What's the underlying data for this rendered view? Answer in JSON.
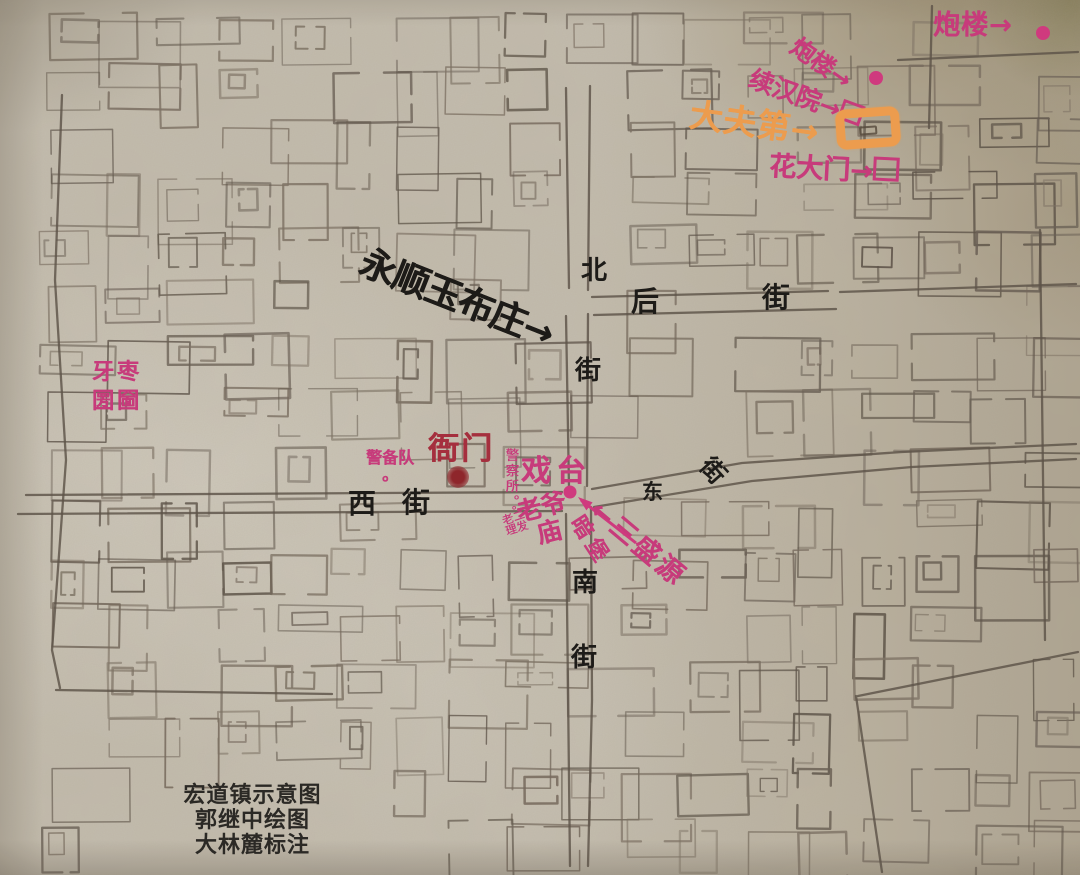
{
  "map": {
    "caption": {
      "line1": "宏道镇示意图",
      "line2": "郭继中绘图",
      "line3": "大林麓标注"
    },
    "streets": {
      "north": {
        "name": "北街",
        "c1": "北",
        "c2": "街"
      },
      "back": {
        "name": "后街",
        "c1": "后",
        "c2": "街"
      },
      "west": {
        "name": "西街",
        "c1": "西",
        "c2": "街"
      },
      "east": {
        "name": "东街",
        "c1": "东",
        "c2": "街"
      },
      "south": {
        "name": "南街",
        "c1": "南",
        "c2": "街"
      }
    },
    "landmarks": {
      "paolou_far": {
        "label": "炮楼→",
        "marker": "dot"
      },
      "paolou_near": {
        "label": "炮楼→",
        "marker": "dot"
      },
      "xuhanyuan": {
        "label": "续汉院→",
        "marker": "gate-box"
      },
      "dafudi": {
        "label": "大夫第→",
        "marker": "orange-highlight-box"
      },
      "huadamen": {
        "label": "花大门→",
        "marker": "gate-box"
      },
      "yongshunyu": {
        "label": "永顺玉布庄→"
      },
      "yazao_kulue": {
        "line1": "牙枣",
        "line2": "圐圙"
      },
      "jingbeidui": {
        "label": "警备队",
        "dot": "。"
      },
      "yamen": {
        "label": "衙门",
        "marker": "dot"
      },
      "jingchasuo": {
        "label": "警察所。"
      },
      "xitai": {
        "label": "戏台"
      },
      "laoyemiao": {
        "line1": "老爷",
        "line2": "庙",
        "marker": "dot"
      },
      "laoer_lifa": {
        "dot": "。",
        "row1": "老二",
        "row2": "理发"
      },
      "anbao": {
        "label": "暗堡",
        "marker": "arrow"
      },
      "sanshengyuan": {
        "label": "←三盛源"
      }
    },
    "colors": {
      "pink": "#c73b7b",
      "orange": "#ec9c4e",
      "dark_red": "#a52f3e",
      "ink": "#1d1b18",
      "pencil": "#5d5348",
      "paper": "#c3bcae"
    }
  }
}
